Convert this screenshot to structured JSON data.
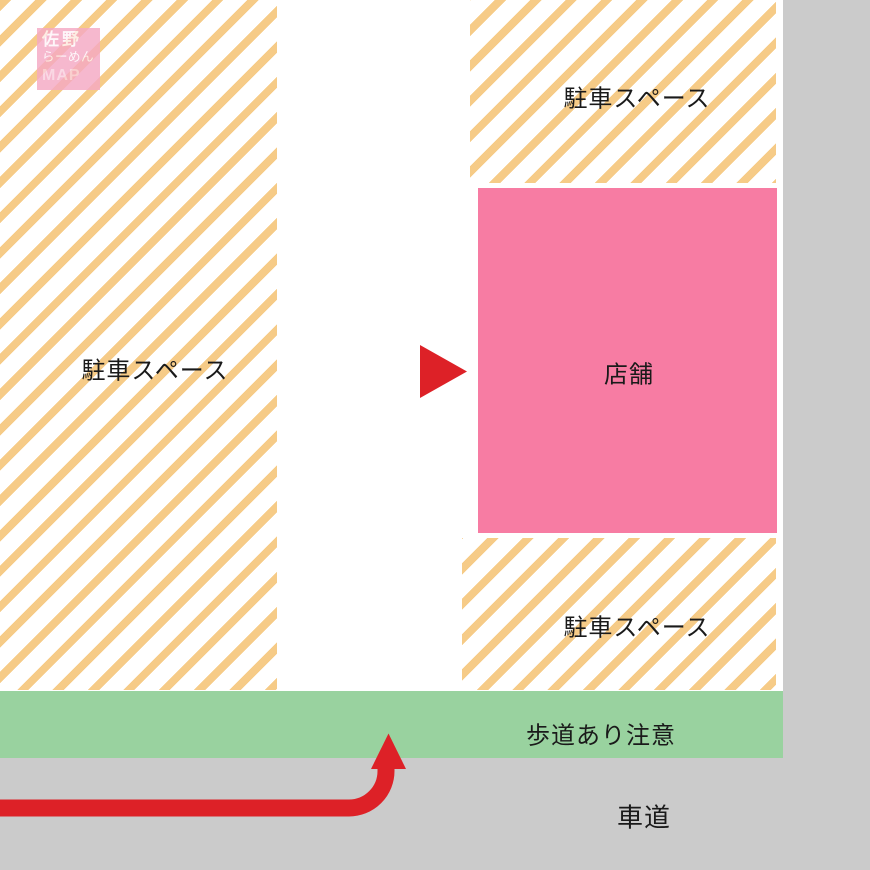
{
  "logo": {
    "title_line1": "佐野",
    "title_line2": "らーめん",
    "title_line3": "MAP"
  },
  "labels": {
    "parking_left": "駐車スペース",
    "parking_top_right": "駐車スペース",
    "parking_bottom_right": "駐車スペース",
    "shop": "店舗",
    "sidewalk_notice": "歩道あり注意",
    "roadway": "車道"
  },
  "icons": {
    "entrance_arrow": "red-right-triangle",
    "route_arrow": "red-curved-up-arrow"
  },
  "colors": {
    "stripe_orange": "#F6CB87",
    "shop_pink": "#F77CA3",
    "sidewalk_green": "#99D29F",
    "road_gray": "#CBCBCB",
    "arrow_red": "#DD2127",
    "logo_pink": "#F4A9C4",
    "text_black": "#1A1A1A"
  }
}
